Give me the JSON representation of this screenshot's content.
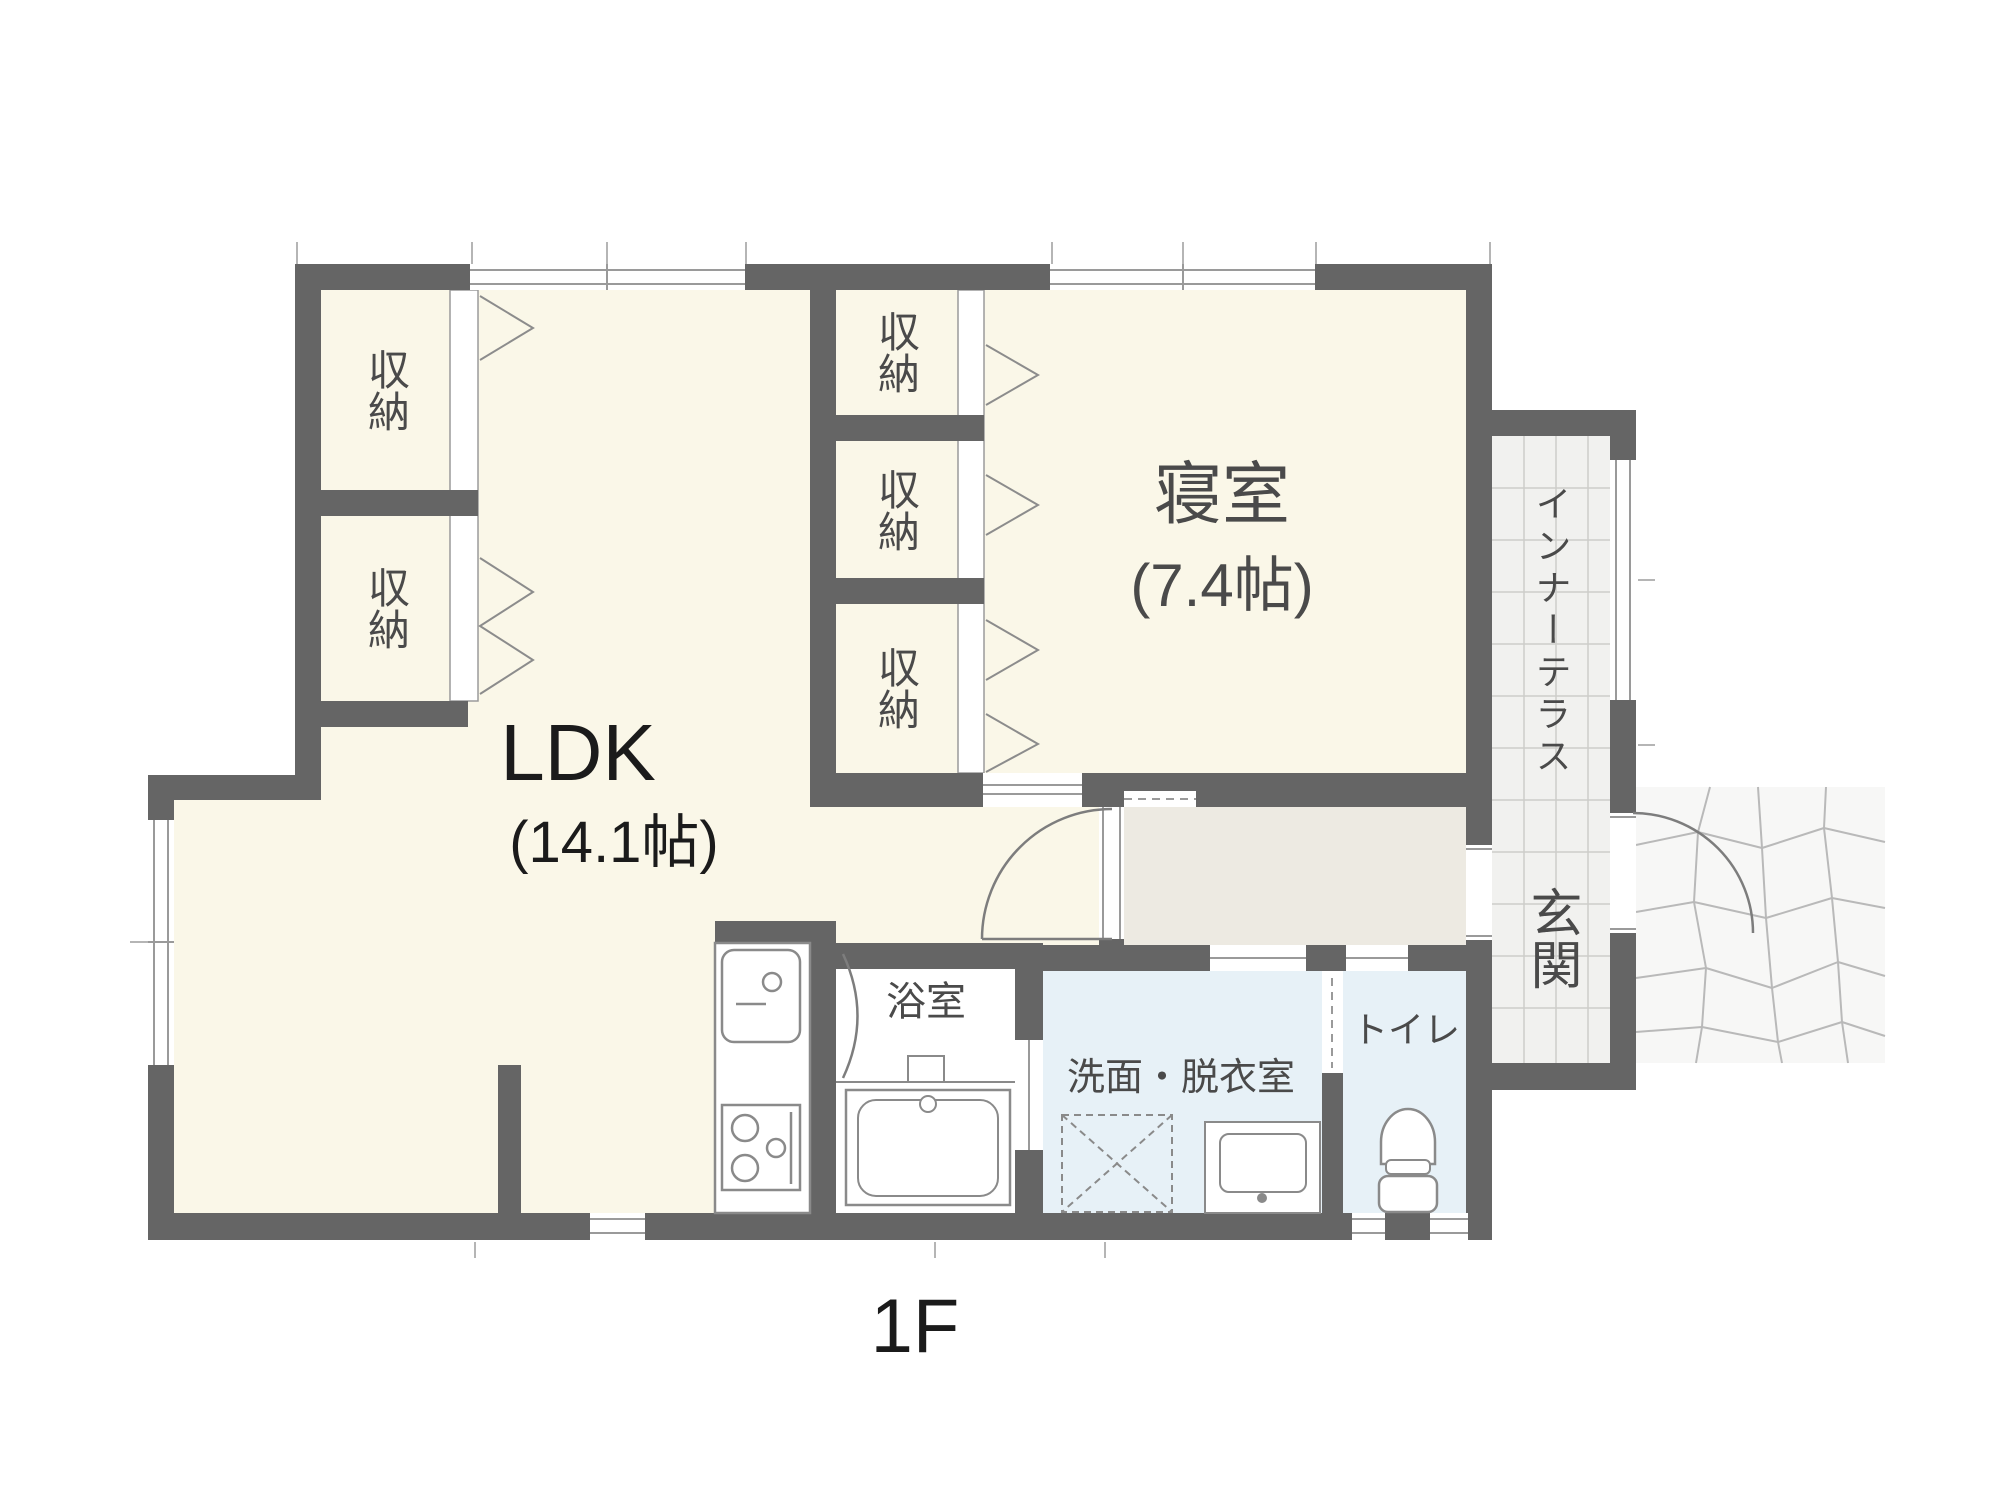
{
  "floor": {
    "label": "1F"
  },
  "rooms": {
    "ldk": {
      "name": "LDK",
      "size": "(14.1帖)"
    },
    "bedroom": {
      "name": "寝室",
      "size": "(7.4帖)"
    },
    "bathroom": {
      "name": "浴室"
    },
    "washroom": {
      "name": "洗面・脱衣室"
    },
    "toilet": {
      "name": "トイレ"
    },
    "inner_terrace": {
      "name": "インナーテラス"
    },
    "entrance": {
      "name": "玄関"
    }
  },
  "closets": [
    "収納",
    "収納",
    "収納",
    "収納",
    "収納"
  ],
  "colors": {
    "wall": "#656565",
    "room_cream": "#FAF7E8",
    "hallway": "#EDEAE2",
    "wet_room": "#E7F1F7",
    "bath_white": "#FFFFFF",
    "terrace_tile": "#F1F1EF",
    "stone": "#F7F7F6",
    "label_text": "#4A4A4A",
    "black_text": "#1B1B1B"
  }
}
